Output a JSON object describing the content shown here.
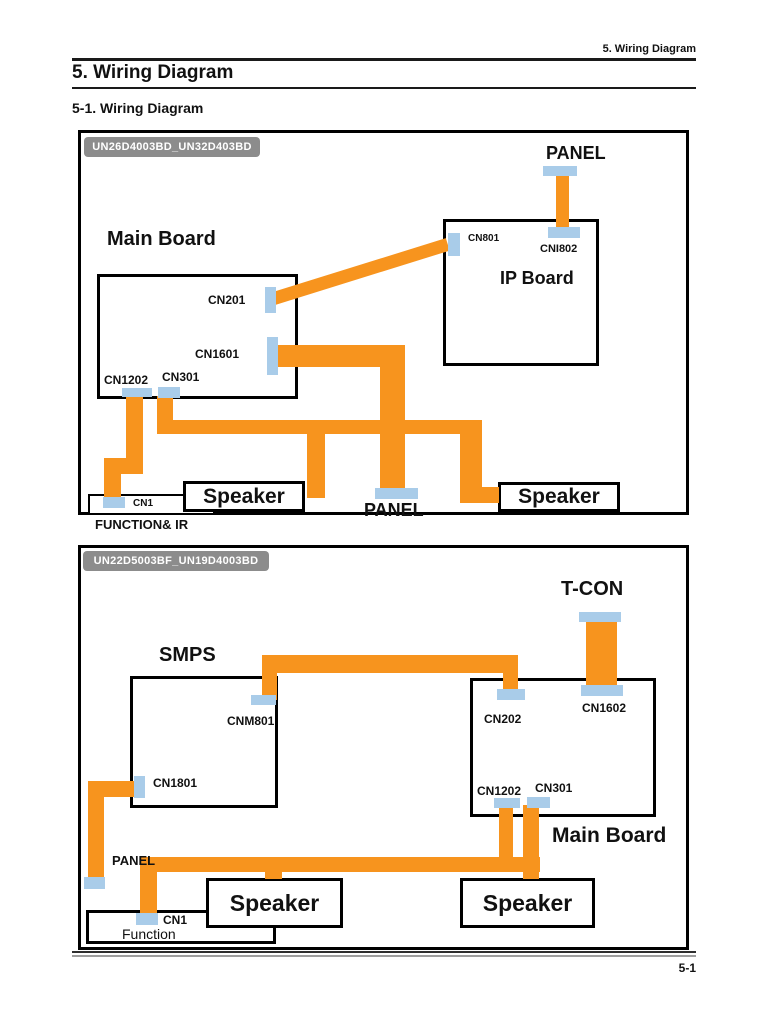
{
  "header": {
    "running_title": "5. Wiring Diagram",
    "title": "5. Wiring Diagram",
    "subtitle": "5-1. Wiring Diagram"
  },
  "footer": {
    "page_number": "5-1"
  },
  "colors": {
    "wire_orange": "#F7941E",
    "connector_blue": "#A9CCE9",
    "badge_gray": "#8C8C8C"
  },
  "diagram1": {
    "model_badge": "UN26D4003BD_UN32D403BD",
    "main_board": {
      "title": "Main Board",
      "cn201": "CN201",
      "cn1601": "CN1601",
      "cn1202": "CN1202",
      "cn301": "CN301"
    },
    "ip_board": {
      "title": "IP Board",
      "cn801": "CN801",
      "cni802": "CNI802"
    },
    "panel_top": "PANEL",
    "panel_bottom": "PANEL",
    "speaker_left": "Speaker",
    "speaker_right": "Speaker",
    "cn1": "CN1",
    "function_ir": "FUNCTION& IR"
  },
  "diagram2": {
    "model_badge": "UN22D5003BF_UN19D4003BD",
    "tcon": "T-CON",
    "smps": {
      "title": "SMPS",
      "cnm801": "CNM801",
      "cn1801": "CN1801"
    },
    "main_board": {
      "title": "Main Board",
      "cn202": "CN202",
      "cn1602": "CN1602",
      "cn1202": "CN1202",
      "cn301": "CN301"
    },
    "panel": "PANEL",
    "speaker_left": "Speaker",
    "speaker_right": "Speaker",
    "cn1": "CN1",
    "function": "Function"
  }
}
